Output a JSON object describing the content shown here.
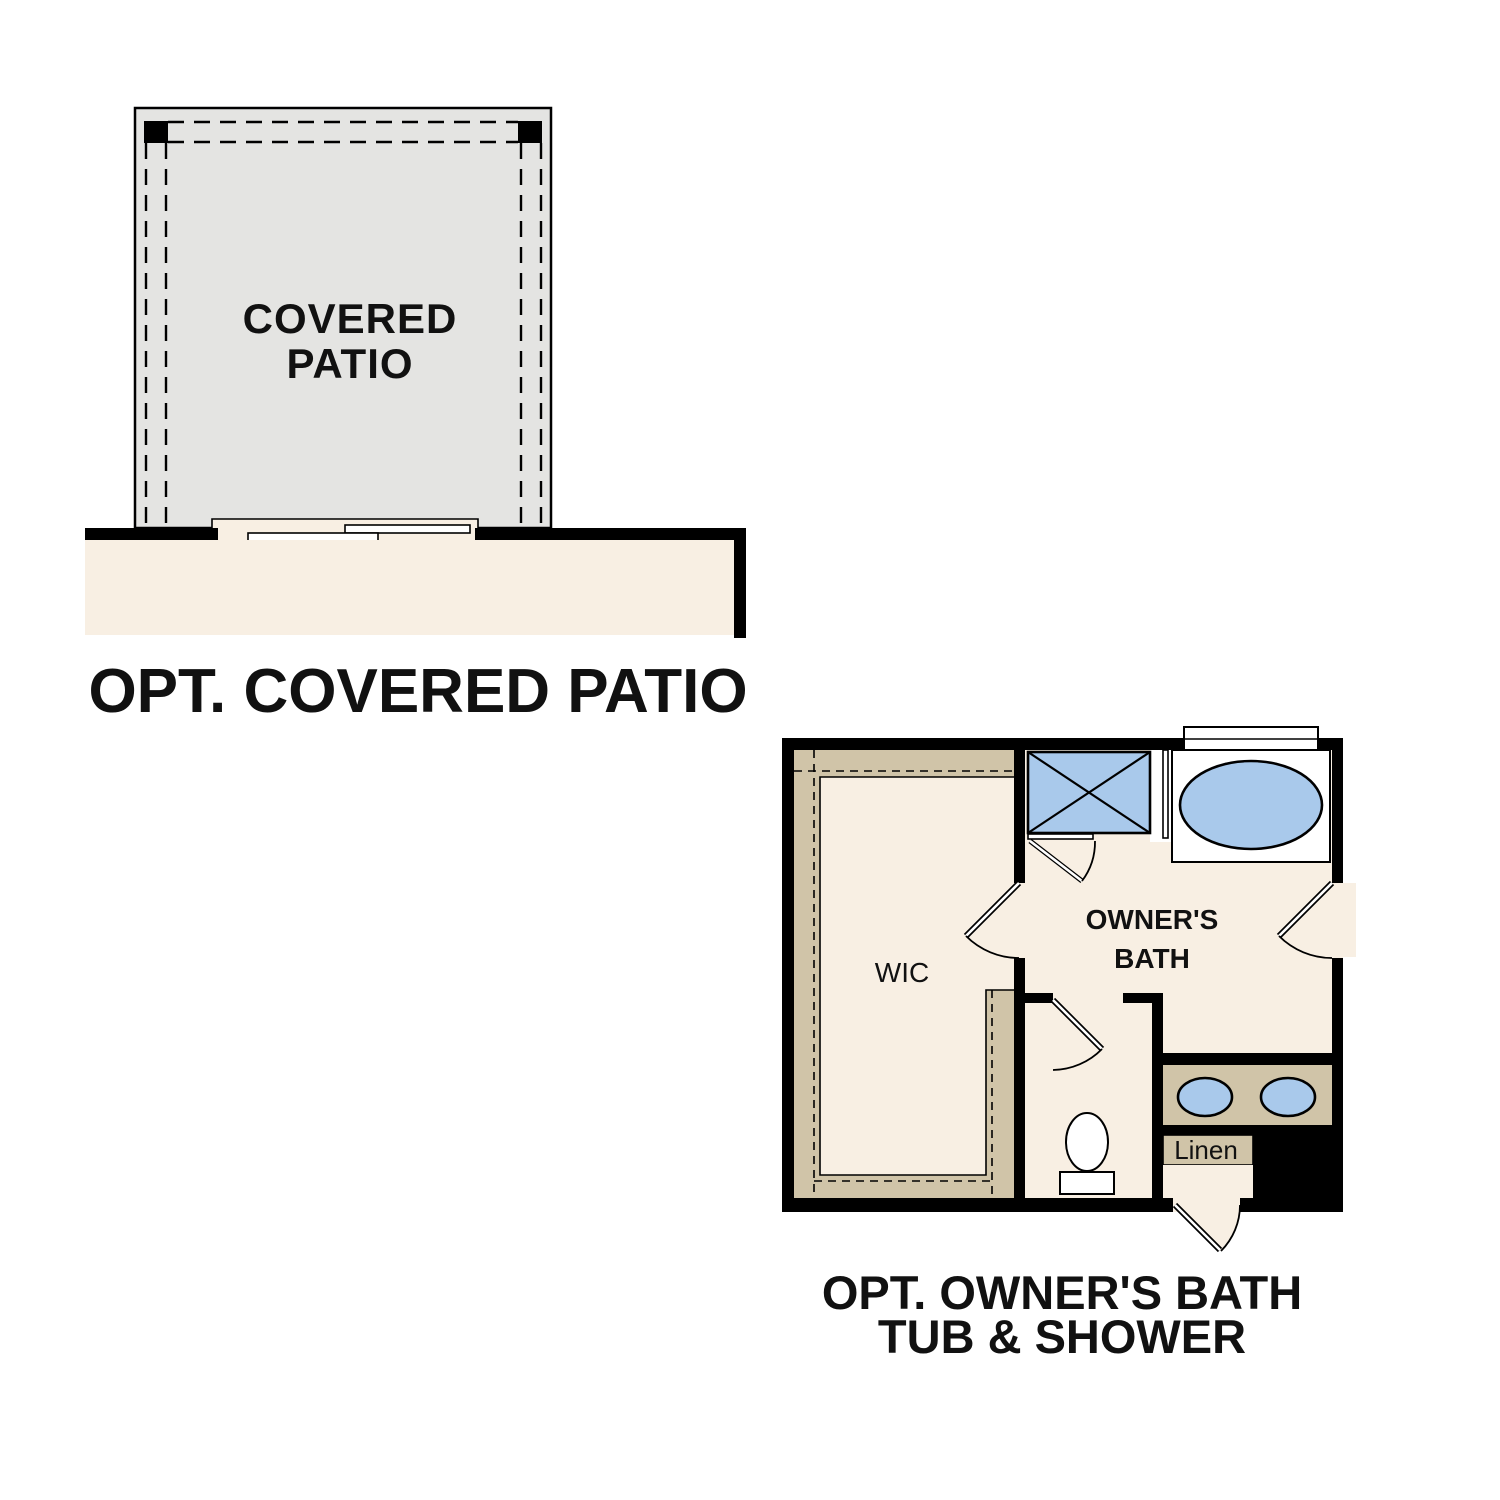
{
  "document": {
    "background": "#ffffff",
    "type": "floor-plan-options-sheet"
  },
  "colors": {
    "ink": "#000000",
    "cream": "#f8efe3",
    "patio_gray": "#e4e4e2",
    "tan": "#d0c4a8",
    "fixture_blue": "#a9c9eb",
    "text": "#111111"
  },
  "patio_plan": {
    "room_label_line1": "COVERED",
    "room_label_line2": "PATIO",
    "title": "OPT. COVERED PATIO"
  },
  "bath_plan": {
    "wic_label": "WIC",
    "room_label_line1": "OWNER'S",
    "room_label_line2": "BATH",
    "linen_label": "Linen",
    "title_line1": "OPT. OWNER'S BATH",
    "title_line2": "TUB & SHOWER"
  }
}
